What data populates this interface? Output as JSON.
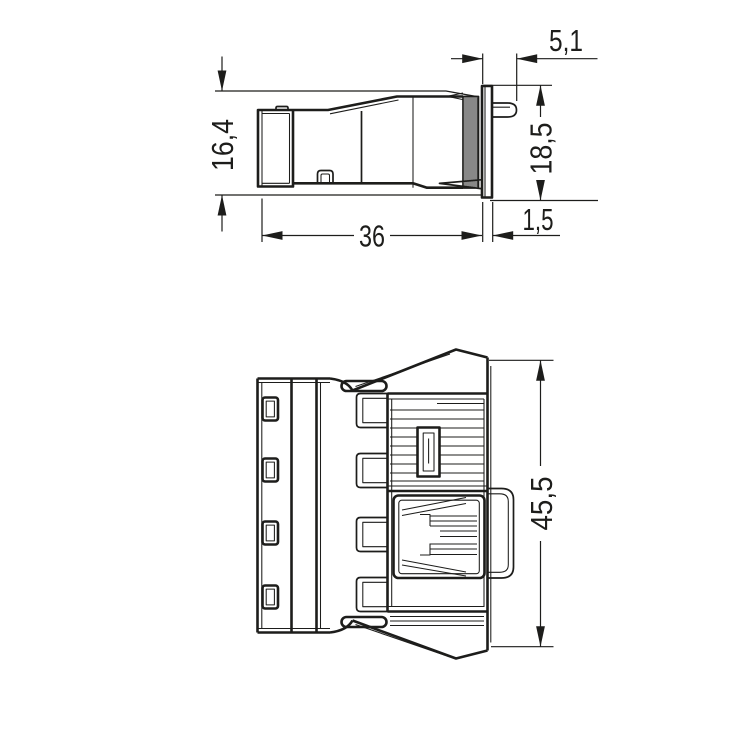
{
  "drawing": {
    "background": "#ffffff",
    "line_color": "#1d1d1b",
    "views": {
      "side": {
        "dims": {
          "pin_protrusion": "5,1",
          "body_height": "16,4",
          "flange_height": "18,5",
          "body_length": "36",
          "flange_thickness": "1,5"
        }
      },
      "front": {
        "dims": {
          "overall_height": "45,5"
        }
      }
    }
  }
}
